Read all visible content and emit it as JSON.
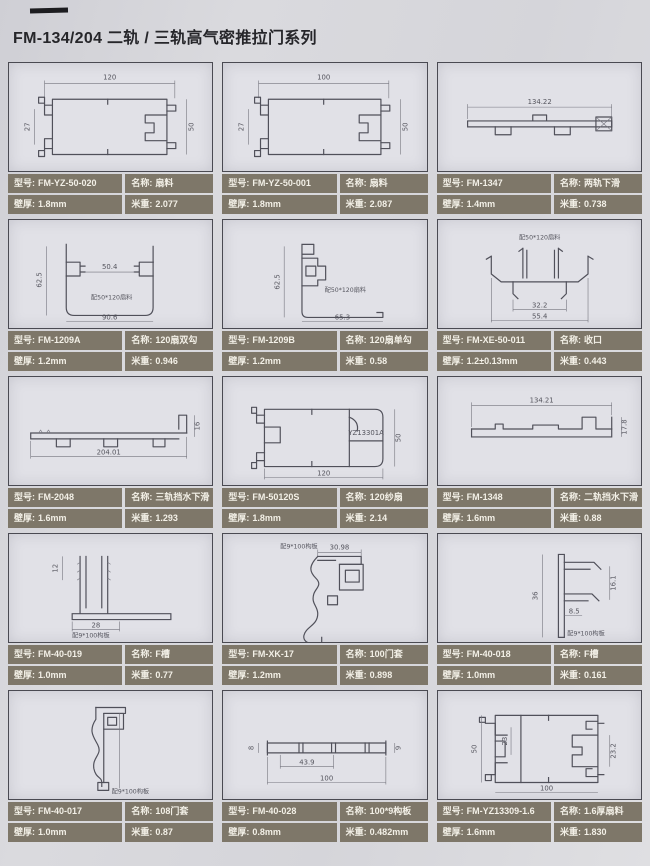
{
  "page": {
    "title": "FM-134/204 二轨 / 三轨高气密推拉门系列"
  },
  "field_labels": {
    "model": "型号:",
    "name": "名称:",
    "wall": "壁厚:",
    "weight": "米重:"
  },
  "colors": {
    "page_bg": "#d6d6db",
    "panel_bg": "#e1e1e7",
    "label_bg": "#7e7769",
    "label_text": "#f3f0e7",
    "line": "#50505a"
  },
  "cells": [
    {
      "model": "FM-YZ-50-020",
      "name": "扇料",
      "wall": "1.8mm",
      "weight": "2.077",
      "dims": {
        "top": "120",
        "left": "27",
        "right": "50"
      }
    },
    {
      "model": "FM-YZ-50-001",
      "name": "扇料",
      "wall": "1.8mm",
      "weight": "2.087",
      "dims": {
        "top": "100",
        "left": "27",
        "right": "50"
      }
    },
    {
      "model": "FM-1347",
      "name": "两轨下滑",
      "wall": "1.4mm",
      "weight": "0.738",
      "dims": {
        "top": "134.22"
      }
    },
    {
      "model": "FM-1209A",
      "name": "120扇双勾",
      "wall": "1.2mm",
      "weight": "0.946",
      "dims": {
        "mid": "50.4",
        "left": "62.5",
        "bottom": "90.6"
      },
      "note": "配50*120扇料"
    },
    {
      "model": "FM-1209B",
      "name": "120扇单勾",
      "wall": "1.2mm",
      "weight": "0.58",
      "dims": {
        "left": "62.5",
        "bottom": "65.3"
      },
      "note": "配50*120扇料"
    },
    {
      "model": "FM-XE-50-011",
      "name": "收口",
      "wall": "1.2±0.13mm",
      "weight": "0.443",
      "dims": {
        "inner": "32.2",
        "bottom": "55.4"
      },
      "note": "配50*120扇料"
    },
    {
      "model": "FM-2048",
      "name": "三轨挡水下滑",
      "wall": "1.6mm",
      "weight": "1.293",
      "dims": {
        "bottom": "204.01",
        "right": "16"
      }
    },
    {
      "model": "FM-50120S",
      "name": "120纱扇",
      "wall": "1.8mm",
      "weight": "2.14",
      "dims": {
        "bottom": "120",
        "right": "50"
      },
      "note": "YZ13301A"
    },
    {
      "model": "FM-1348",
      "name": "二轨挡水下滑",
      "wall": "1.6mm",
      "weight": "0.88",
      "dims": {
        "top": "134.21",
        "right": "17.8"
      }
    },
    {
      "model": "FM-40-019",
      "name": "F槽",
      "wall": "1.0mm",
      "weight": "0.77",
      "dims": {
        "left": "12",
        "bottom": "28"
      },
      "note": "配9*100构板"
    },
    {
      "model": "FM-XK-17",
      "name": "100门套",
      "wall": "1.2mm",
      "weight": "0.898",
      "dims": {
        "top": "30.98"
      },
      "note": "配9*100构板"
    },
    {
      "model": "FM-40-018",
      "name": "F槽",
      "wall": "1.0mm",
      "weight": "0.161",
      "dims": {
        "left": "36",
        "inner": "8.5",
        "right": "16.1"
      },
      "note": "配9*100构板"
    },
    {
      "model": "FM-40-017",
      "name": "108门套",
      "wall": "1.0mm",
      "weight": "0.87",
      "note": "配9*100构板"
    },
    {
      "model": "FM-40-028",
      "name": "100*9构板",
      "wall": "0.8mm",
      "weight": "0.482mm",
      "dims": {
        "left": "8",
        "right": "9",
        "inner": "43.9",
        "bottom": "100"
      }
    },
    {
      "model": "FM-YZ13309-1.6",
      "name": "1.6厚扇料",
      "wall": "1.6mm",
      "weight": "1.830",
      "dims": {
        "left": "50",
        "inner": "23",
        "right": "23.2",
        "bottom": "100"
      }
    }
  ]
}
